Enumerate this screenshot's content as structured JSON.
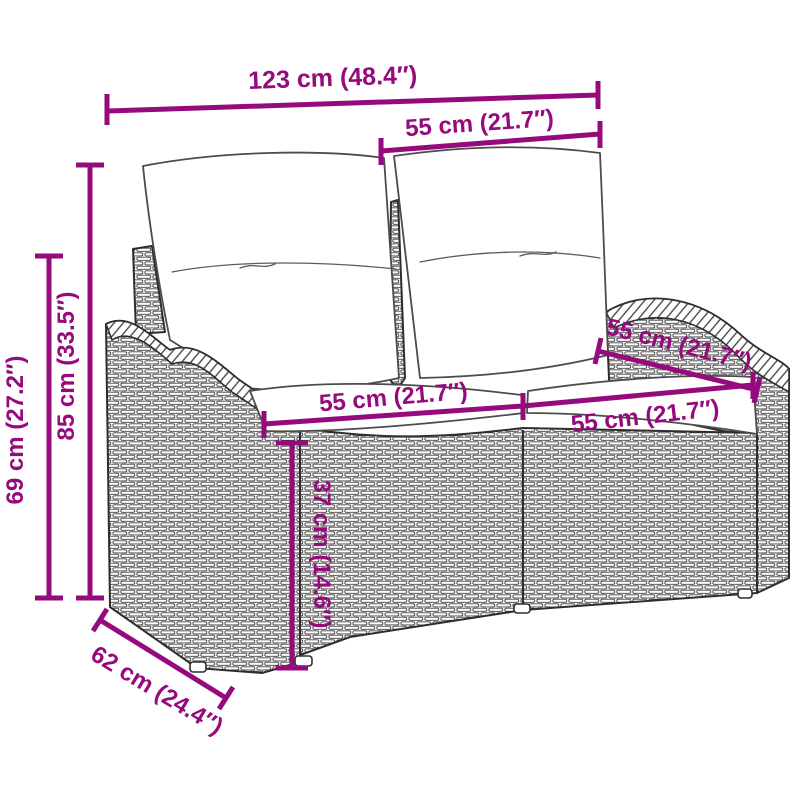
{
  "title": "Garden bench dimension diagram",
  "accent_color": "#950B7D",
  "outline_color": "#2E2E2E",
  "background_color": "#FFFFFF",
  "product": {
    "name": "poly rattan garden bench with cushions",
    "parts": [
      "left armrest",
      "right armrest",
      "left back cushion",
      "right back cushion",
      "left seat cushion",
      "right seat cushion",
      "wicker seat base",
      "back posts"
    ]
  },
  "dimensions": {
    "overall_width": {
      "label": "123 cm (48.4″)",
      "cm": 123,
      "inches": 48.4
    },
    "back_section_width": {
      "label": "55 cm (21.7″)",
      "cm": 55,
      "inches": 21.7
    },
    "total_height": {
      "label": "85 cm (33.5″)",
      "cm": 85,
      "inches": 33.5
    },
    "arm_height": {
      "label": "69 cm (27.2″)",
      "cm": 69,
      "inches": 27.2
    },
    "seat_width_left": {
      "label": "55 cm (21.7″)",
      "cm": 55,
      "inches": 21.7
    },
    "seat_width_right": {
      "label": "55 cm (21.7″)",
      "cm": 55,
      "inches": 21.7
    },
    "backrest_width_right": {
      "label": "55 cm (21.7″)",
      "cm": 55,
      "inches": 21.7
    },
    "seat_height": {
      "label": "37 cm (14.6″)",
      "cm": 37,
      "inches": 14.6
    },
    "depth": {
      "label": "62 cm (24.4″)",
      "cm": 62,
      "inches": 24.4
    }
  }
}
